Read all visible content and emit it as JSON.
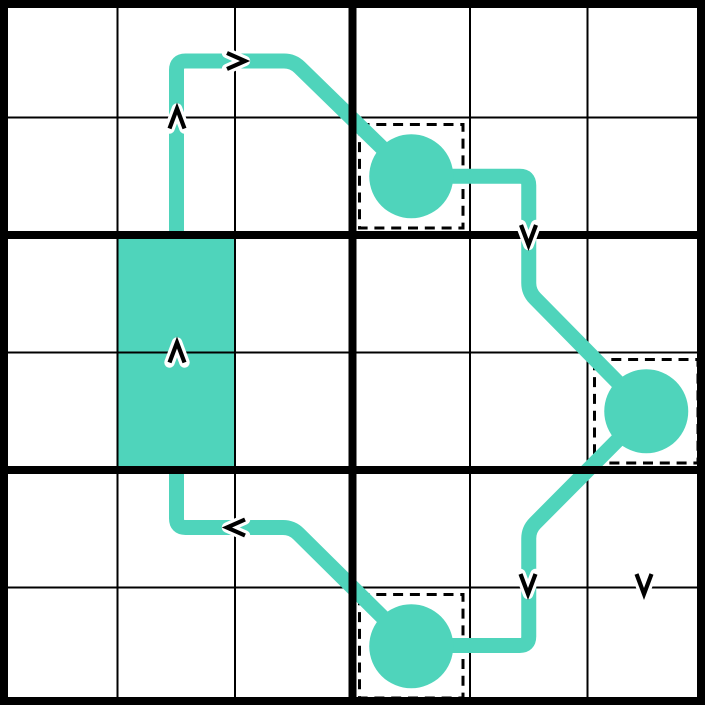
{
  "board": {
    "size": 705,
    "rows": 6,
    "cols": 6,
    "cell": 117.5,
    "box_rows": 2,
    "box_cols": 3,
    "colors": {
      "background": "#ffffff",
      "path": "#4fd4bb",
      "grid_thin": "#000000",
      "grid_bold": "#000000",
      "dash_box": "#000000",
      "arrow": "#000000",
      "arrow_halo": "#ffffff"
    },
    "stroke": {
      "thin": 2,
      "bold": 8,
      "outer": 8,
      "path": 15,
      "dash_box": 3,
      "dash_pattern": "10 6.8",
      "arrow": 4.2,
      "arrow_halo": 10.5
    },
    "filled_cells": [
      {
        "col": 1,
        "row": 2
      },
      {
        "col": 1,
        "row": 3
      }
    ],
    "bulbs": [
      {
        "col": 3,
        "row": 1
      },
      {
        "col": 5,
        "row": 3
      },
      {
        "col": 3,
        "row": 5
      }
    ],
    "bulb_radius": 42,
    "dashed_boxes": [
      {
        "col": 3,
        "row": 1
      },
      {
        "col": 5,
        "row": 3
      },
      {
        "col": 3,
        "row": 5
      }
    ],
    "dash_inset": 7,
    "corner_radius": 9,
    "path_points": [
      [
        176.5,
        245
      ],
      [
        176.5,
        61
      ],
      [
        293,
        61
      ],
      [
        411.25,
        176.25
      ],
      [
        528.75,
        176.25
      ],
      [
        528.75,
        292
      ],
      [
        646.25,
        411.25
      ],
      [
        528.75,
        529.5
      ],
      [
        528.75,
        645.5
      ],
      [
        411.25,
        645.5
      ],
      [
        292,
        527.5
      ],
      [
        176.5,
        527.5
      ],
      [
        176.5,
        460
      ]
    ],
    "arrows": [
      {
        "dir": "up",
        "x": 177,
        "y": 118.5
      },
      {
        "dir": "right",
        "x": 236,
        "y": 61
      },
      {
        "dir": "down",
        "x": 528.5,
        "y": 235
      },
      {
        "dir": "up",
        "x": 177,
        "y": 352.5
      },
      {
        "dir": "left",
        "x": 236,
        "y": 527.5
      },
      {
        "dir": "down",
        "x": 528,
        "y": 584
      },
      {
        "dir": "down",
        "x": 644,
        "y": 584
      }
    ]
  }
}
